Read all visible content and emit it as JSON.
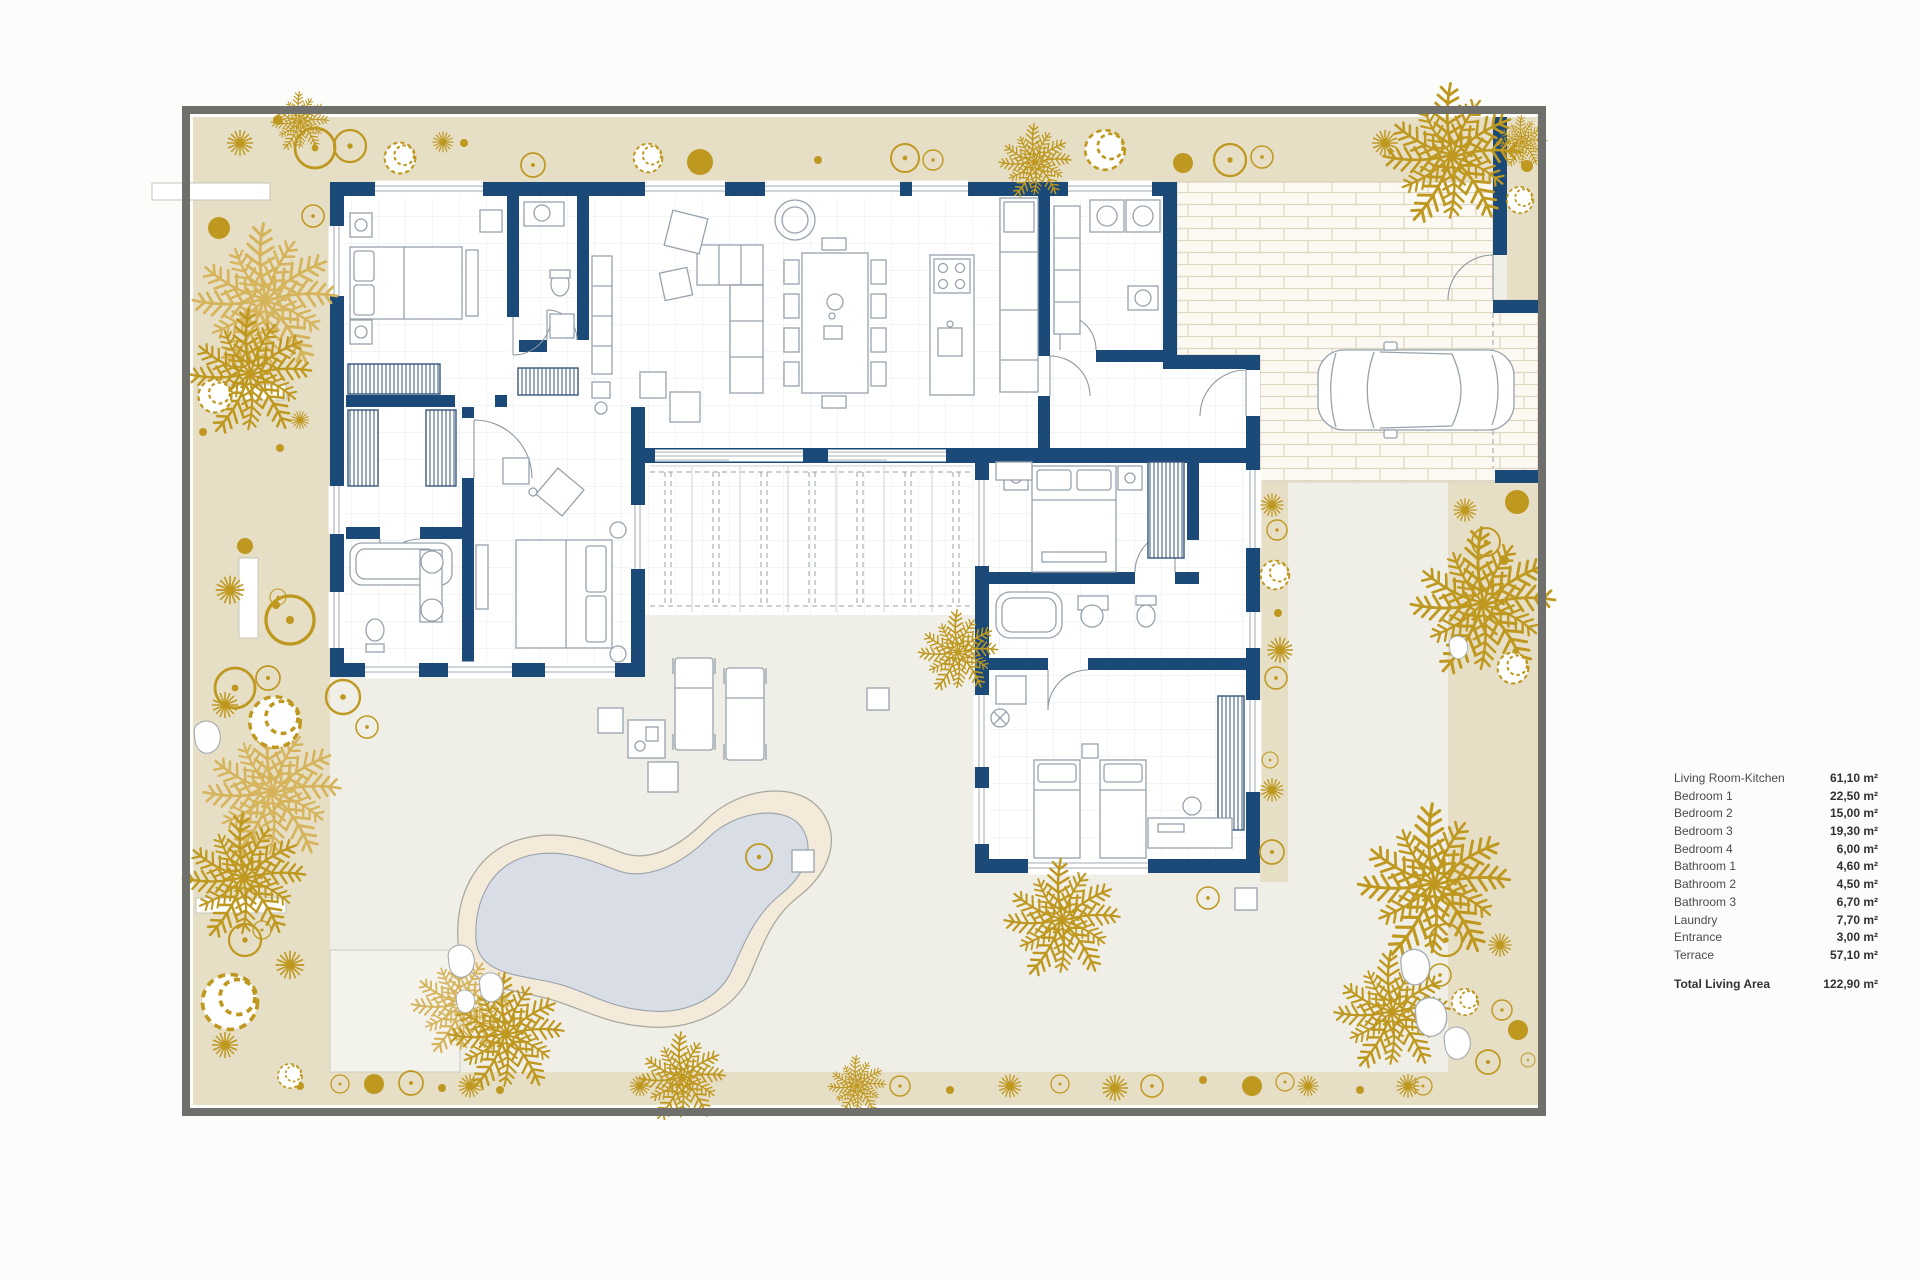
{
  "title": "Villa floor plan with garden, pool and area legend",
  "legend": {
    "rows": [
      {
        "label": "Living Room-Kitchen",
        "value": "61,10 m²"
      },
      {
        "label": "Bedroom 1",
        "value": "22,50 m²"
      },
      {
        "label": "Bedroom 2",
        "value": "15,00 m²"
      },
      {
        "label": "Bedroom 3",
        "value": "19,30 m²"
      },
      {
        "label": "Bedroom 4",
        "value": "6,00 m²"
      },
      {
        "label": "Bathroom 1",
        "value": "4,60 m²"
      },
      {
        "label": "Bathroom 2",
        "value": "4,50 m²"
      },
      {
        "label": "Bathroom 3",
        "value": "6,70 m²"
      },
      {
        "label": "Laundry",
        "value": "7,70 m²"
      },
      {
        "label": "Entrance",
        "value": "3,00 m²"
      },
      {
        "label": "Terrace",
        "value": "57,10 m²"
      }
    ],
    "total": {
      "label": "Total Living Area",
      "value": "122,90 m²"
    }
  },
  "colors": {
    "wall_navy": "#1b4978",
    "garden_tan": "#e6dfc6",
    "vegetation_gold": "#bf9820",
    "vegetation_gold_light": "#d6b45c",
    "courtyard": "#f0efe7",
    "floor_white": "#ffffff",
    "grid_line": "#e4ebf2",
    "pool_water": "#d9dee6",
    "pool_deck": "#f4ead9",
    "paving_bg": "#fbf9f1",
    "paving_line": "#ded6c1",
    "border_gray": "#6f6f6b",
    "furniture_line": "#98a2ac",
    "legend_text": "#4b4b4b"
  },
  "icons": {
    "palm-tree-icon": "radial gold palm fronds",
    "star-plant-icon": "gold starburst plant",
    "shrub-ring-icon": "gold outlined circle shrub",
    "shrub-dot-icon": "solid gold shrub",
    "bush-icon": "wiggly outlined bush",
    "rock-icon": "white pebble",
    "car-icon": "sedan top view",
    "pool-icon": "kidney shaped pool"
  }
}
